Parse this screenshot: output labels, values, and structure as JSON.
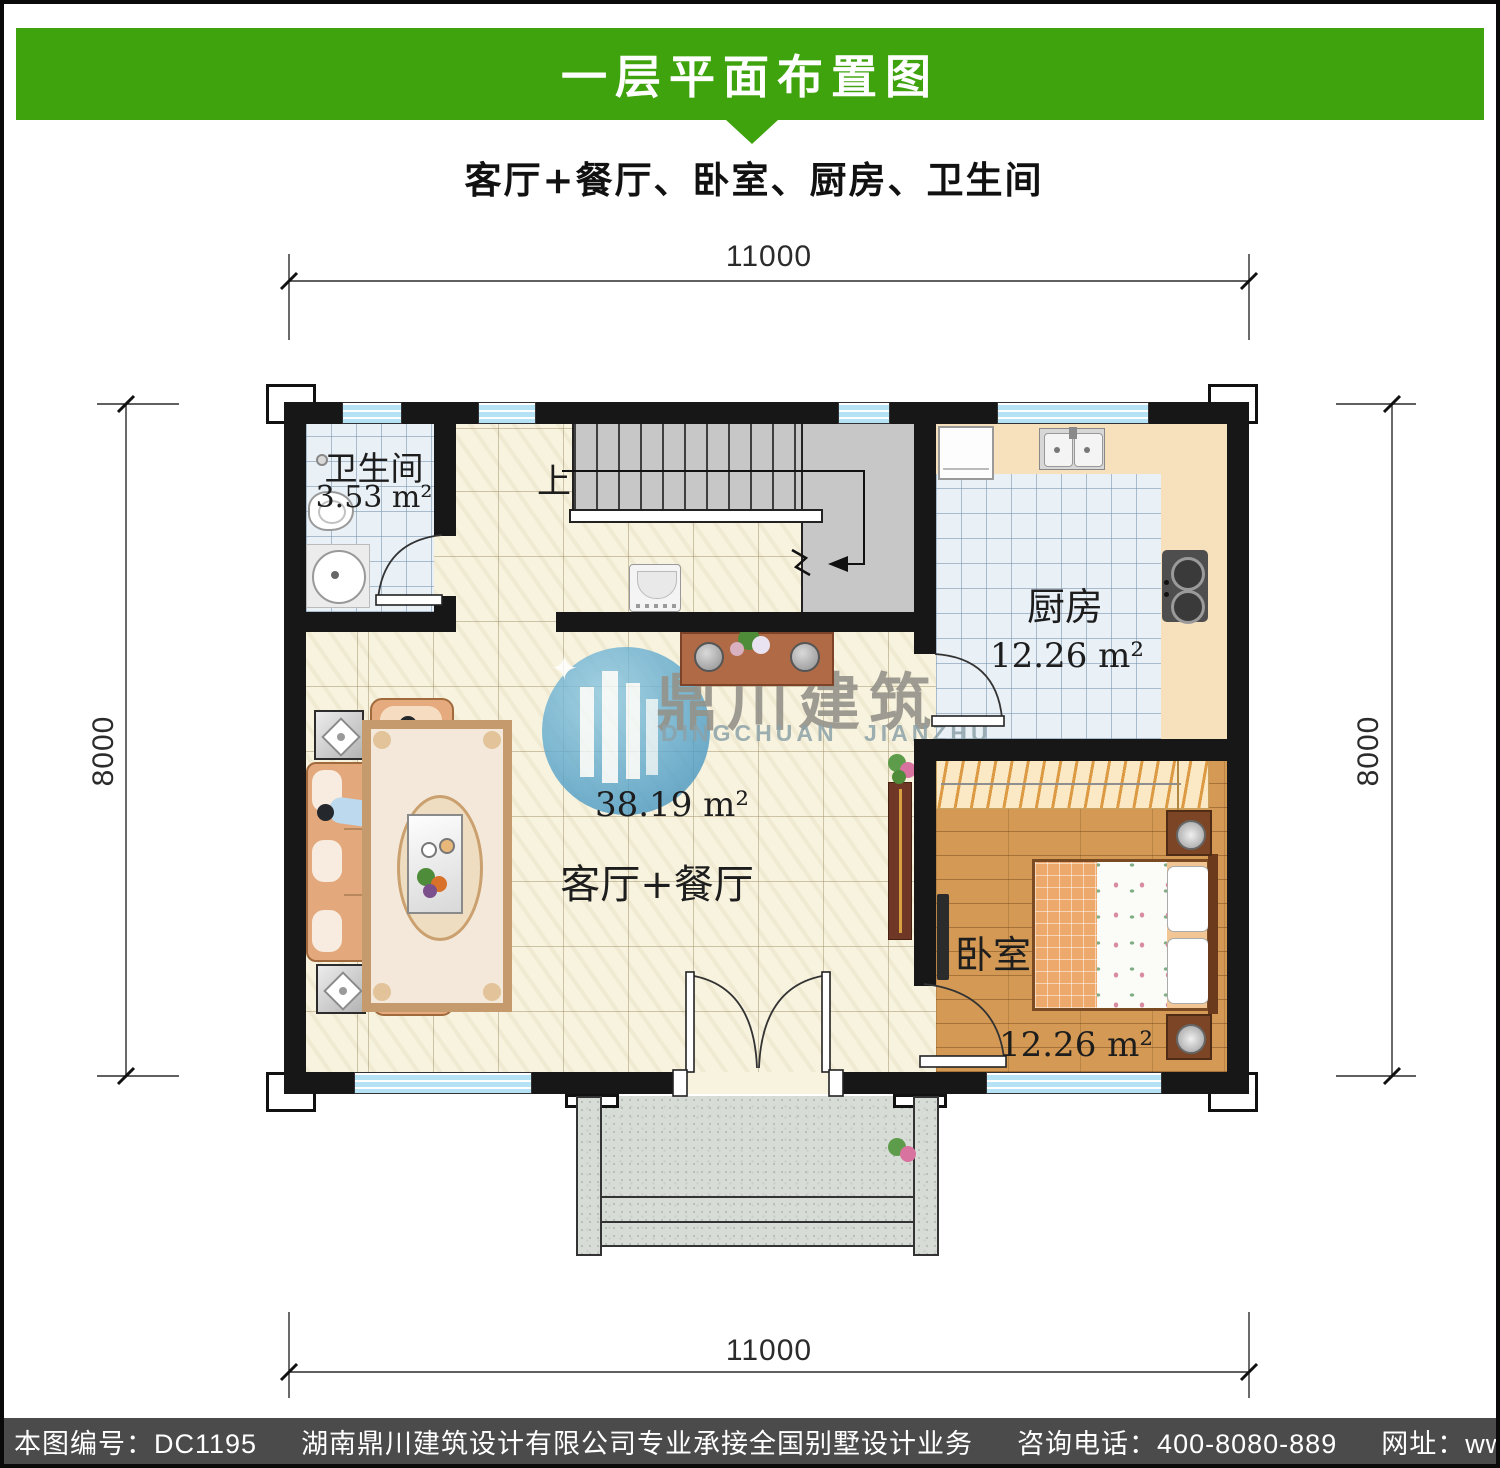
{
  "header": {
    "title": "一层平面布置图",
    "subtitle": "客厅+餐厅、卧室、厨房、卫生间"
  },
  "dimensions": {
    "top": "11000",
    "bottom": "11000",
    "left": "8000",
    "right": "8000"
  },
  "rooms": {
    "bathroom": {
      "name": "卫生间",
      "area": "3.53 m²"
    },
    "kitchen": {
      "name": "厨房",
      "area": "12.26 m²"
    },
    "living_dining": {
      "name": "客厅+餐厅",
      "area": "38.19 m²"
    },
    "bedroom": {
      "name": "卧室",
      "area": "12.26 m²"
    }
  },
  "stairs": {
    "up_label": "上"
  },
  "watermark": {
    "logo_cn": "鼎川建筑",
    "logo_en": "DINGCHUAN JIANZHU"
  },
  "footer": {
    "sheet_no": "本图编号：DC1195",
    "company": "湖南鼎川建筑设计有限公司专业承接全国别墅设计业务",
    "phone": "咨询电话：400-8080-889",
    "website": "网址：www.bstzcs.com"
  },
  "colors": {
    "header_green": "#3fa30d",
    "footer_gray": "#4b4b4b",
    "wall_black": "#171717",
    "floor_cream": "#f8f3de",
    "tile_blue": "#e9f0f6",
    "counter_peach": "#f7e1bd",
    "wood_floor": "#d49a55",
    "window_blue": "#b5e2f4",
    "stair_gray": "#c7c7c7",
    "porch_gray": "#d7dcd6",
    "watermark_blue": "#5ba6cb"
  }
}
